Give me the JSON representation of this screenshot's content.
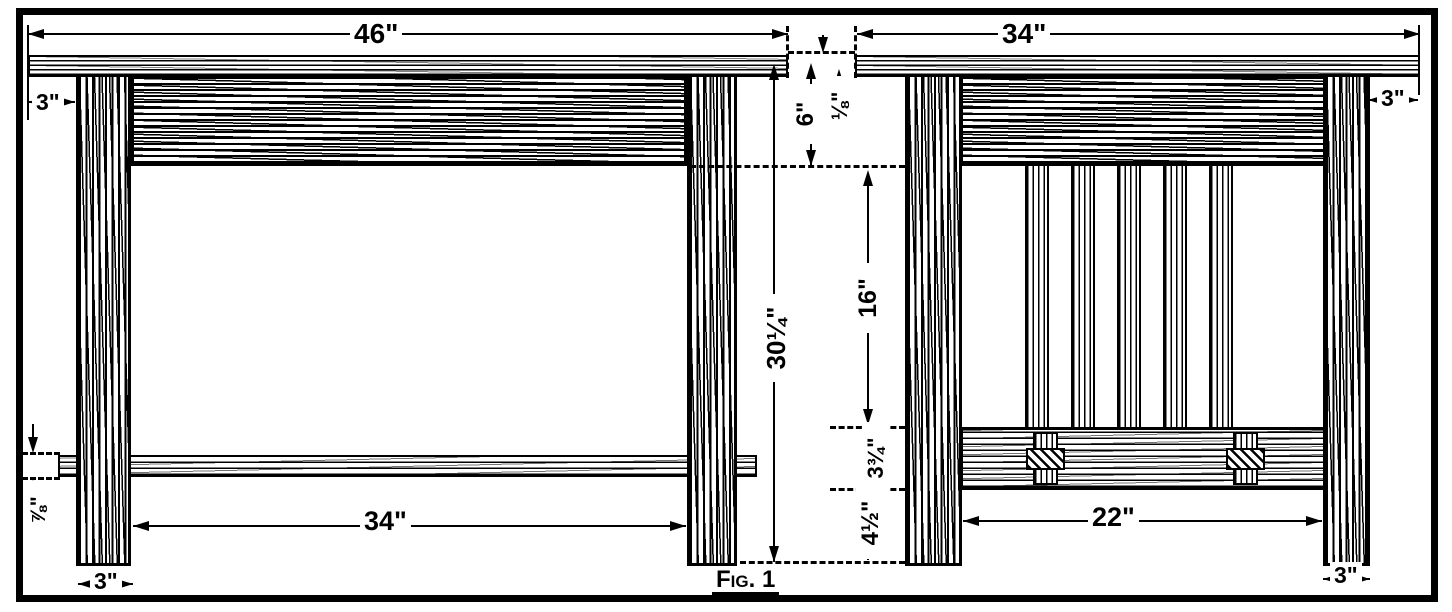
{
  "figure": {
    "caption": "Fig. 1"
  },
  "dims": {
    "front_top_width": "46\"",
    "side_top_width": "34\"",
    "front_top_overhang": "3\"",
    "side_top_overhang": "3\"",
    "front_leg_width_bottom": "3\"",
    "side_leg_width_bottom": "3\"",
    "front_between_legs": "34\"",
    "side_between_legs": "22\"",
    "height_below_top": "30¼\"",
    "rail_depth": "6\"",
    "top_reveal": "⅛\"",
    "slat_length": "16\"",
    "shelf_depth": "3¾\"",
    "shelf_to_floor": "4½\"",
    "stretcher_thickness": "⅞\""
  }
}
